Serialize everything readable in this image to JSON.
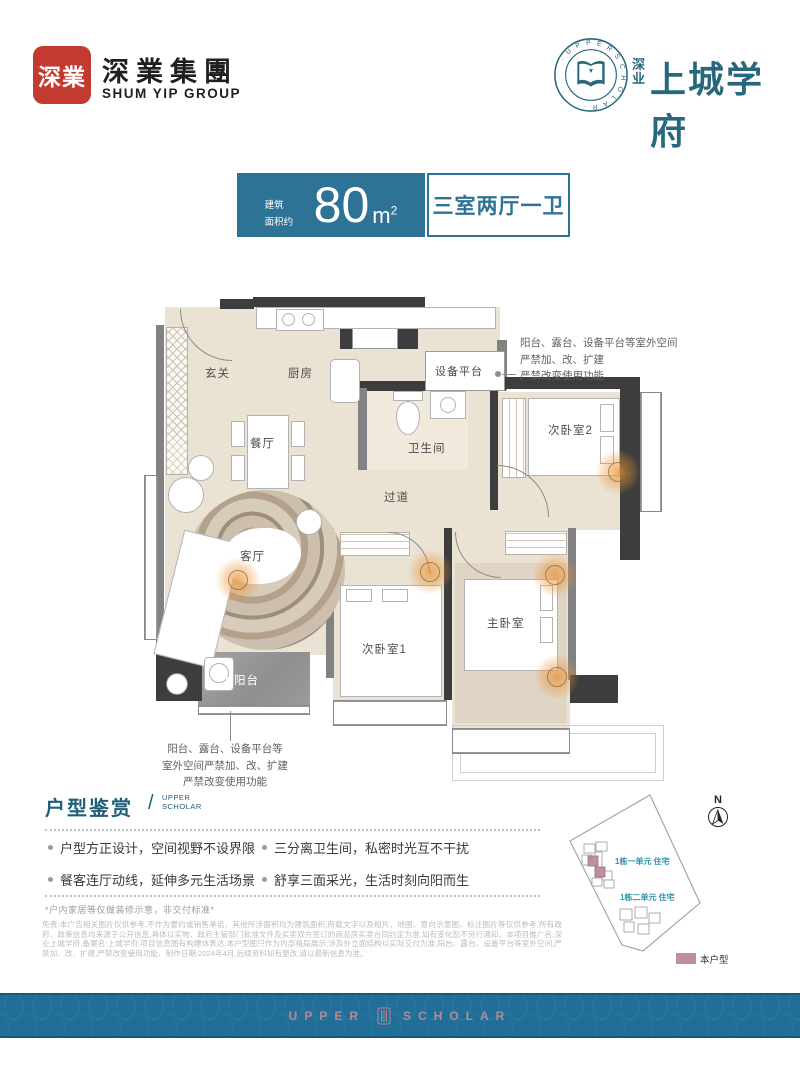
{
  "header": {
    "seal_chars": "深業",
    "company_cn": "深業集團",
    "company_en": "SHUM YIP GROUP",
    "emblem_ring_text": "· U P P E R S C H O L A R ·",
    "brand_prefix": "深业",
    "brand_name": "上城学府"
  },
  "badges": {
    "area_prefix_l1": "建筑",
    "area_prefix_l2": "面积约",
    "area_number": "80",
    "area_unit_base": "m",
    "area_unit_sup": "2",
    "layout_label": "三室两厅一卫"
  },
  "floorplan": {
    "rooms": {
      "entry": "玄关",
      "kitchen": "厨房",
      "dining": "餐厅",
      "living": "客厅",
      "balcony": "阳台",
      "corridor": "过道",
      "bathroom": "卫生间",
      "equipment": "设备平台",
      "bedroom2": "次卧室2",
      "bedroom1": "次卧室1",
      "master": "主卧室",
      "duct": "YD"
    },
    "annotation_top": {
      "l1": "阳台、露台、设备平台等室外空间",
      "l2": "严禁加、改、扩建",
      "l3": "严禁改变使用功能"
    },
    "annotation_bottom": {
      "l1": "阳台、露台、设备平台等",
      "l2": "室外空间严禁加、改、扩建",
      "l3": "严禁改变使用功能"
    }
  },
  "features": {
    "title": "户型鉴赏",
    "title_en_l1": "UPPER",
    "title_en_l2": "SCHOLAR",
    "bullets": [
      "户型方正设计，空间视野不设界限",
      "三分离卫生间，私密时光互不干扰",
      "餐客连厅动线，延伸多元生活场景",
      "舒享三面采光，生活时刻向阳而生"
    ],
    "note": "*户内家居等仅做装修示意，非交付标准*",
    "disclaimer": "免责:本广告相关图片仅供参考,不作为要约或销售承诺、其他所涉面积均为建筑面积,所载文字以及相片、地图、意向示意图、标注图片等仅供参考,所有政府、政策信息均来源于公开信息,具体以实物、政府主管部门批准文件及买卖双方签订的商品房买卖合同约定为准,如有变化恕不另行通知、本项目推广名:深业上城学府,备案名:上城学府,项目信息图有构建体表达,本户型图只作为内部格局展示,涉及外立面结构以实际交付为准,阳台、露台、设备平台等室外空间,严禁加、改、扩建,严禁改变使用功能、制作日期:2024年4月,后续资料如有更改,请以最新信息为准。"
  },
  "siteplan": {
    "compass": "N",
    "unit1_label": "1栋一单元 住宅",
    "unit2_label": "1栋二单元 住宅",
    "legend_label": "本户型"
  },
  "footer": {
    "brand_l": "UPPER",
    "brand_r": "SCHOLAR"
  },
  "colors": {
    "brand_blue": "#2e7396",
    "brand_teal": "#28687e",
    "accent_mauve": "#bf8f9b",
    "seal_red": "#c23a30"
  }
}
